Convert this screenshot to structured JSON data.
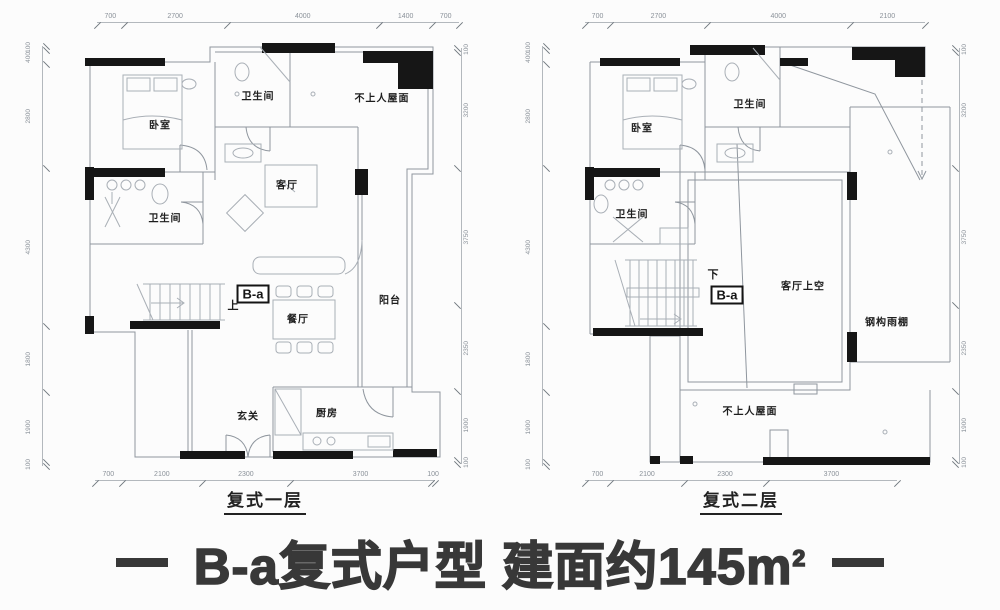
{
  "title": {
    "dash_left": "",
    "text": "B-a复式户型 建面约145m",
    "sup": "2",
    "dash_right": ""
  },
  "floor1": {
    "caption": "复式一层",
    "dims_top": [
      "700",
      "2700",
      "4000",
      "1400",
      "700"
    ],
    "dims_left": [
      "100",
      "400",
      "2800",
      "4300",
      "1800",
      "1900",
      "100"
    ],
    "dims_right": [
      "100",
      "3200",
      "3750",
      "2350",
      "1900",
      "100"
    ],
    "dims_bottom": [
      "700",
      "2100",
      "2300",
      "3700",
      "100"
    ],
    "rooms": {
      "bedroom": "卧室",
      "bath1": "卫生间",
      "bath2": "卫生间",
      "roof": "不上人屋面",
      "living": "客厅",
      "balcony": "阳台",
      "dining": "餐厅",
      "entry": "玄关",
      "kitchen": "厨房",
      "stairs_up": "上",
      "marker": "B-a"
    }
  },
  "floor2": {
    "caption": "复式二层",
    "dims_top": [
      "700",
      "2700",
      "4000",
      "2100"
    ],
    "dims_left": [
      "100",
      "400",
      "2800",
      "4300",
      "1800",
      "1900",
      "100"
    ],
    "dims_right": [
      "100",
      "3200",
      "3750",
      "2350",
      "1900",
      "100"
    ],
    "dims_bottom": [
      "700",
      "2100",
      "2300",
      "3700"
    ],
    "rooms": {
      "bedroom": "卧室",
      "bath1": "卫生间",
      "bath2": "卫生间",
      "living_void": "客厅上空",
      "canopy": "钢构雨棚",
      "roof": "不上人屋面",
      "stairs_down": "下",
      "marker": "B-a"
    }
  },
  "colors": {
    "background": "#fcfcfc",
    "wall": "#161616",
    "line": "#8f969e",
    "dim_text": "#8a9199",
    "label_text": "#1d1d1d",
    "title_text": "#383838"
  }
}
